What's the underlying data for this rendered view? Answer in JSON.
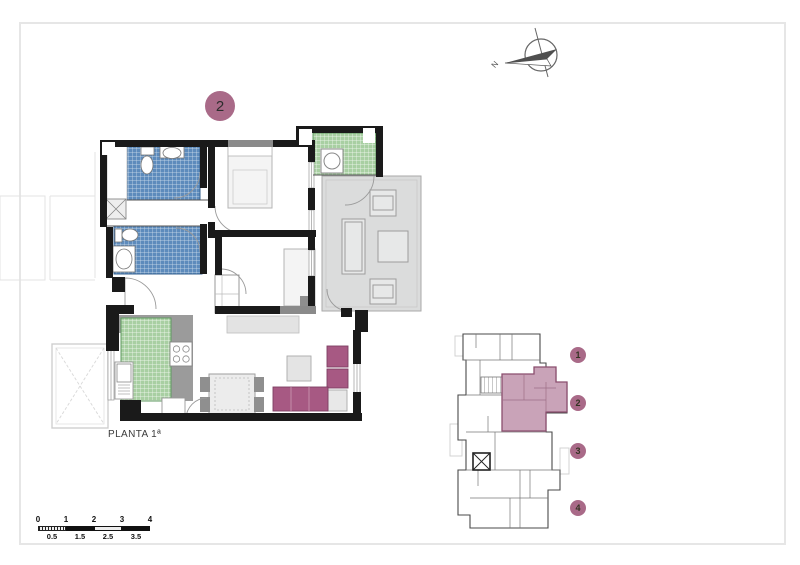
{
  "floor_plan": {
    "unit_badge": "2",
    "floor_label": "PLANTA 1ª"
  },
  "compass": {
    "north_label": "N"
  },
  "scale_bar": {
    "top_labels": [
      "0",
      "1",
      "2",
      "3",
      "4"
    ],
    "bottom_labels": [
      "0.5",
      "1.5",
      "2.5",
      "3.5"
    ]
  },
  "key_plan": {
    "highlighted_unit": "2",
    "units": [
      {
        "number": "1"
      },
      {
        "number": "2"
      },
      {
        "number": "3"
      },
      {
        "number": "4"
      }
    ]
  },
  "colors": {
    "accent_mauve": "#a96a88",
    "unit_highlight_pink": "#c9a3b8",
    "bath_tile_blue": "#5d8bbc",
    "kitchen_tile_green": "#a8cfa2",
    "terrace_gray": "#dbdcdc",
    "sofa_plum": "#a75983",
    "wall_black": "#1a1a1a"
  }
}
